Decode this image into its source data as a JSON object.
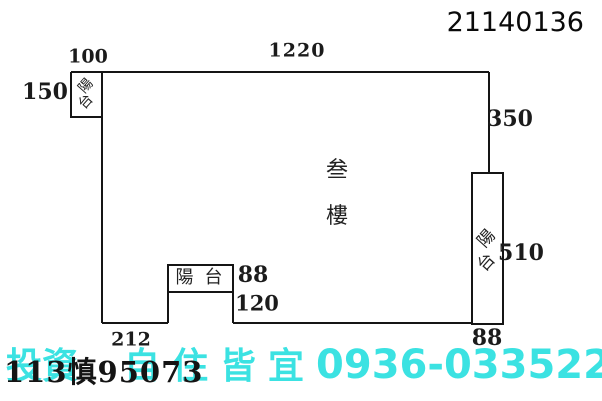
{
  "document": {
    "ref_number": "21140136",
    "case_number": "113慎95073"
  },
  "floor_plan": {
    "floor_label": "叁樓",
    "floor_char_1": "叁",
    "floor_char_2": "樓",
    "balcony_label": "陽台",
    "balcony_char_1": "陽",
    "balcony_char_2": "台",
    "dimensions": {
      "balcony_top_width": "100",
      "top_width": "1220",
      "balcony_left_height": "150",
      "right_upper_height": "350",
      "right_balcony_height": "510",
      "right_balcony_bottom_width": "88",
      "mid_balcony_width": "88",
      "mid_balcony_depth": "120",
      "bottom_left_width": "212"
    },
    "line_color": "#151515"
  },
  "watermark": {
    "text_part_1": "投資",
    "text_part_2": "自住皆宜",
    "phone": "0936-033522",
    "color": "#3be2e2"
  }
}
